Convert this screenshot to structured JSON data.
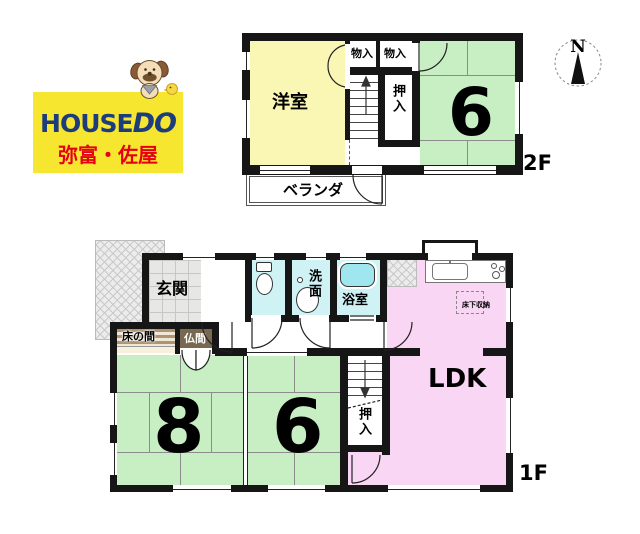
{
  "logo": {
    "house": "HOUSE",
    "do": "DO",
    "branch": "弥富・佐屋"
  },
  "compass": {
    "north": "N"
  },
  "floor2": {
    "label": "2F",
    "rooms": {
      "western": "洋室",
      "storage1": "物入",
      "storage2": "物入",
      "closet": "押入",
      "tatami6": "6",
      "veranda": "ベランダ"
    }
  },
  "floor1": {
    "label": "1F",
    "rooms": {
      "entrance": "玄関",
      "tokonoma": "床の間",
      "butsuma": "仏間",
      "washroom": "洗面",
      "bathroom": "浴室",
      "underfloor": "床下収納",
      "ldk": "LDK",
      "tatami8": "8",
      "tatami6": "6",
      "closet": "押入"
    }
  },
  "colors": {
    "wall": "#161616",
    "room-yellow": "#FAF6B4",
    "room-green": "#C8EFC3",
    "room-pink": "#F9D6F3",
    "room-cyan": "#CFF2F5",
    "tub-cyan": "#9FE6EF",
    "tile": "#E7E7E5",
    "matline": "#8C8C8C",
    "tokonoma-dark": "#AE9473",
    "tokonoma-light": "#F0E7D5",
    "cream": "#F6F0DC",
    "butsuma-brown": "#77684F",
    "logo-yellow": "#F7E62F",
    "logo-blue": "#1D3C7C",
    "logo-red": "#E60013"
  }
}
